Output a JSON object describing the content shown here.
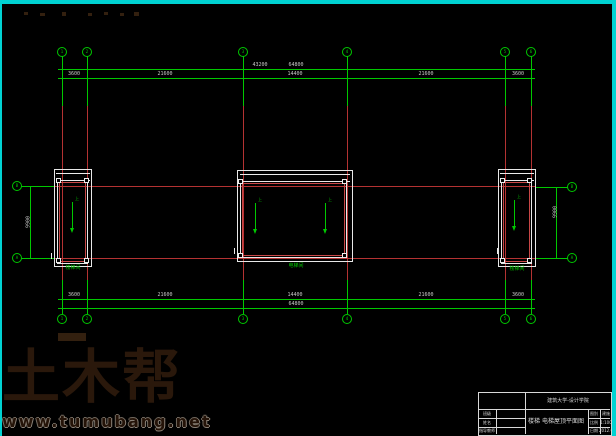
{
  "colors": {
    "background": "#000000",
    "grid_green": "#00c800",
    "grid_red": "#b43232",
    "wall_white": "#ececec",
    "border_cyan": "#00d2d2",
    "watermark_brown": "#2a180b"
  },
  "drawing": {
    "axes": {
      "top": [
        "1",
        "2",
        "3",
        "4",
        "5",
        "6"
      ],
      "bottom": [
        "1",
        "2",
        "3",
        "4",
        "5",
        "6"
      ],
      "left": [
        "B",
        "A"
      ],
      "right": [
        "B",
        "A"
      ]
    },
    "dims": {
      "top": {
        "segments": [
          "3600",
          "21600",
          "14400",
          "21600",
          "3600"
        ],
        "overall_left": "43200",
        "overall": "64800"
      },
      "bottom": {
        "segments": [
          "3600",
          "21600",
          "14400",
          "21600",
          "3600"
        ],
        "overall": "64800"
      },
      "left": {
        "overall": "9900"
      },
      "right": {
        "overall": "9900"
      }
    },
    "rooms": {
      "left_label": "楼梯间",
      "center_label": "电梯间",
      "right_label": "楼梯间",
      "arrow_label": "上"
    }
  },
  "titleblock": {
    "school": "建筑大学-设计学院",
    "fields": [
      {
        "label": "班级",
        "value": ""
      },
      {
        "label": "姓名",
        "value": ""
      },
      {
        "label": "指导教师",
        "value": ""
      }
    ],
    "title": "楼梯 电梯屋顶平面图",
    "meta": [
      {
        "label": "图别",
        "value": "建施"
      },
      {
        "label": "比例",
        "value": "1:100"
      },
      {
        "label": "日期",
        "value": "2012.6"
      }
    ]
  },
  "watermark": {
    "logo": "土木帮",
    "url": "www.tumubang.net"
  }
}
